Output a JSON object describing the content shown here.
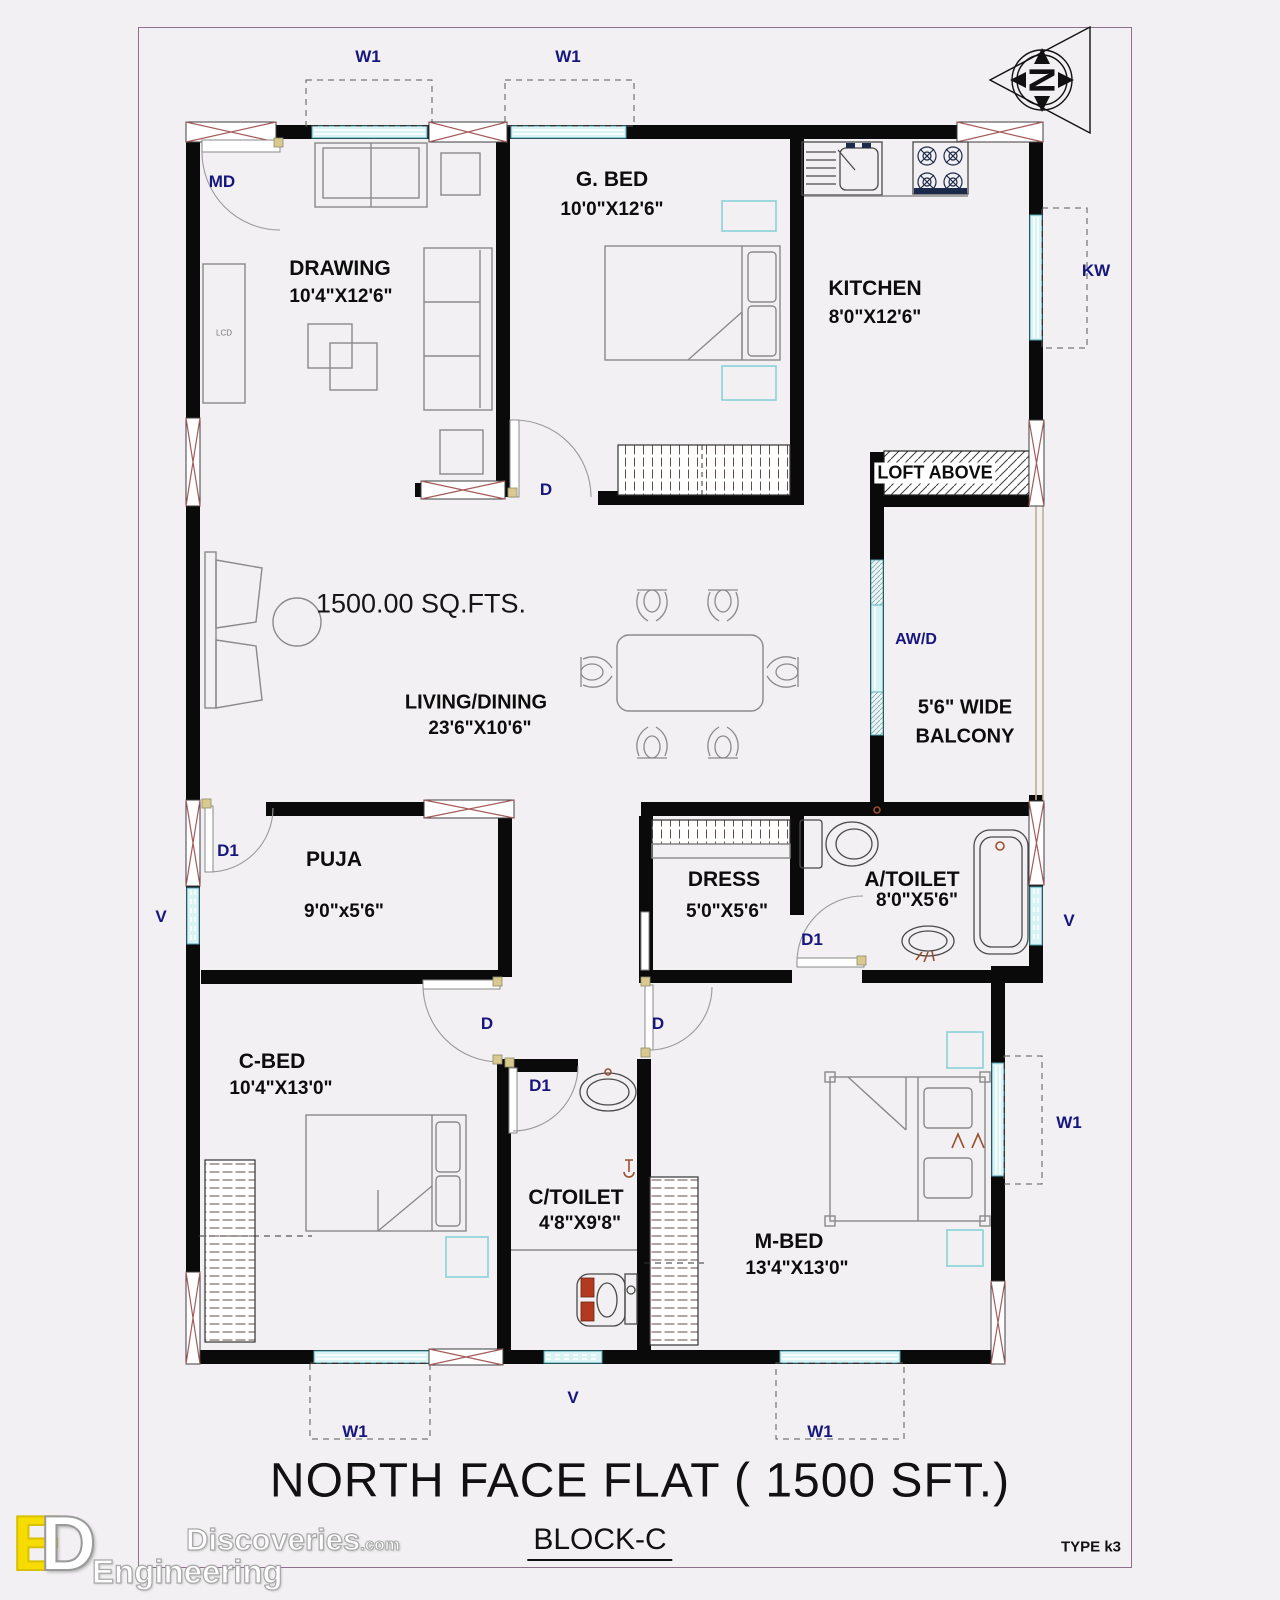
{
  "colors": {
    "label": "#16167e",
    "window_fill": "#d9f3f5",
    "window_edge": "#4aa6b0",
    "xbox": "#a65b5b",
    "furniture": "#8a8a8a",
    "accent_red": "#b23a1e",
    "logo_yellow": "#f7dc00"
  },
  "compass": {
    "letter": "N"
  },
  "area_label": "1500.00 SQ.FTS.",
  "rooms": {
    "drawing": {
      "name": "DRAWING",
      "dims": "10'4\"X12'6\""
    },
    "gbed": {
      "name": "G. BED",
      "dims": "10'0\"X12'6\""
    },
    "kitchen": {
      "name": "KITCHEN",
      "dims": "8'0\"X12'6\""
    },
    "loft": {
      "name": "LOFT ABOVE"
    },
    "balcony": {
      "line1": "5'6\" WIDE",
      "line2": "BALCONY"
    },
    "living": {
      "name": "LIVING/DINING",
      "dims": "23'6\"X10'6\""
    },
    "puja": {
      "name": "PUJA",
      "dims": "9'0\"x5'6\""
    },
    "dress": {
      "name": "DRESS",
      "dims": "5'0\"X5'6\""
    },
    "atoilet": {
      "name": "A/TOILET",
      "dims": "8'0\"X5'6\""
    },
    "cbed": {
      "name": "C-BED",
      "dims": "10'4\"X13'0\""
    },
    "ctoilet": {
      "name": "C/TOILET",
      "dims": "4'8\"X9'8\""
    },
    "mbed": {
      "name": "M-BED",
      "dims": "13'4\"X13'0\""
    }
  },
  "opening_labels": {
    "w1": "W1",
    "v": "V",
    "kw": "KW",
    "md": "MD",
    "awd": "AW/D",
    "d": "D",
    "d1": "D1"
  },
  "furniture_labels": {
    "tv": "LCD"
  },
  "footer": {
    "title": "NORTH FACE FLAT ( 1500 SFT.)",
    "block": "BLOCK-C",
    "type_code": "TYPE k3"
  },
  "watermark": {
    "brand": "Discoveries",
    "brand_suffix": ".com",
    "division": "Engineering",
    "monogram": [
      "E",
      "D"
    ]
  }
}
